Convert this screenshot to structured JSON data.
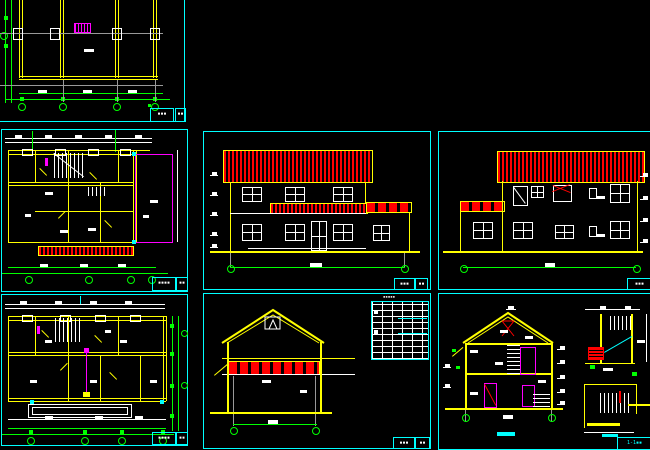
{
  "document": {
    "type": "CAD architectural drawing sheet",
    "background_color": "#000000",
    "frame_color": "#00ffff",
    "wall_color": "#ffff00",
    "dimension_color": "#00ff00",
    "roof_hatch_color": "#ff0000",
    "highlight_color": "#ff00ff",
    "detail_color": "#ffffff"
  },
  "viewports": [
    {
      "name": "roof-framing-plan",
      "title": "▪▪▪",
      "sheet_no": "▪▪"
    },
    {
      "name": "second-floor-plan",
      "title": "▪▪▪▪",
      "sheet_no": "▪▪"
    },
    {
      "name": "ground-floor-plan",
      "title": "▪▪▪▪",
      "sheet_no": "▪▪"
    },
    {
      "name": "front-elevation",
      "title": "▪▪▪",
      "sheet_no": "▪▪"
    },
    {
      "name": "rear-elevation",
      "title": "▪▪▪"
    },
    {
      "name": "side-elevation",
      "title": "▪▪▪",
      "sheet_no": "▪▪"
    },
    {
      "name": "section-1-1",
      "title": "1-1▪▪"
    }
  ],
  "schedule": {
    "title": "▪▪▪▪▪",
    "rows": 11,
    "cols": 5
  }
}
